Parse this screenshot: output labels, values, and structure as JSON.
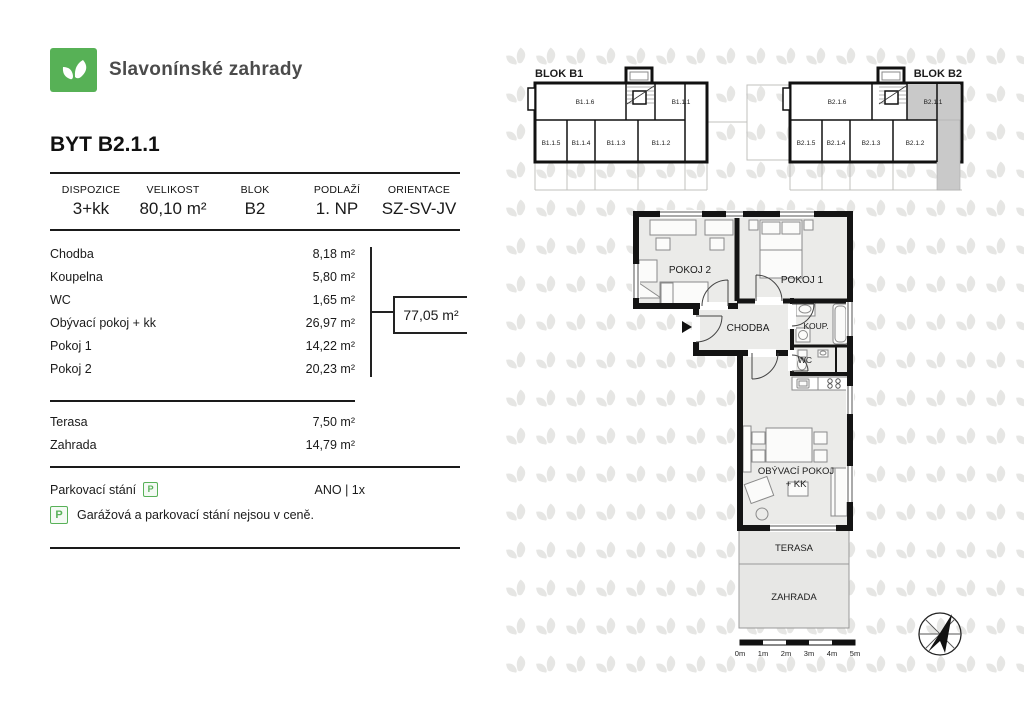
{
  "brand": {
    "name": "Slavonínské zahrady",
    "logo": "leaf-icon"
  },
  "page_title": "BYT B2.1.1",
  "specs": [
    {
      "label": "DISPOZICE",
      "value": "3+kk"
    },
    {
      "label": "VELIKOST",
      "value": "80,10 m²"
    },
    {
      "label": "BLOK",
      "value": "B2"
    },
    {
      "label": "PODLAŽÍ",
      "value": "1. NP"
    },
    {
      "label": "ORIENTACE",
      "value": "SZ-SV-JV"
    }
  ],
  "rooms": [
    {
      "name": "Chodba",
      "area": "8,18 m²"
    },
    {
      "name": "Koupelna",
      "area": "5,80 m²"
    },
    {
      "name": "WC",
      "area": "1,65 m²"
    },
    {
      "name": "Obývací pokoj + kk",
      "area": "26,97 m²"
    },
    {
      "name": "Pokoj 1",
      "area": "14,22 m²"
    },
    {
      "name": "Pokoj 2",
      "area": "20,23 m²"
    }
  ],
  "total_area": "77,05 m²",
  "outdoor": [
    {
      "name": "Terasa",
      "area": "7,50 m²"
    },
    {
      "name": "Zahrada",
      "area": "14,79 m²"
    }
  ],
  "parking": {
    "label": "Parkovací stání",
    "badge": "P",
    "value": "ANO | 1x"
  },
  "note": {
    "badge": "P",
    "text": "Garážová a parkovací stání nejsou v ceně."
  },
  "site_plan": {
    "block_b1": {
      "name": "BLOK B1",
      "units": {
        "top_left": "B1.1.6",
        "top_right": "B1.1.1",
        "bottom": [
          "B1.1.5",
          "B1.1.4",
          "B1.1.3",
          "B1.1.2"
        ]
      }
    },
    "block_b2": {
      "name": "BLOK B2",
      "units": {
        "top_left": "B2.1.6",
        "top_right": "B2.1.1",
        "bottom": [
          "B2.1.5",
          "B2.1.4",
          "B2.1.3",
          "B2.1.2"
        ]
      },
      "highlighted_unit": "B2.1.1"
    }
  },
  "floor_plan": {
    "rooms": {
      "pokoj2": "POKOJ 2",
      "pokoj1": "POKOJ 1",
      "chodba": "CHODBA",
      "koup": "KOUP.",
      "wc": "WC",
      "obyvaci_line1": "OBÝVACÍ POKOJ",
      "obyvaci_line2": "+ KK",
      "terasa": "TERASA",
      "zahrada": "ZAHRADA"
    },
    "scale": [
      "0m",
      "1m",
      "2m",
      "3m",
      "4m",
      "5m"
    ]
  },
  "colors": {
    "brand_green": "#57b156",
    "parking_green": "#58b158",
    "highlight_gray": "#c9c9c9",
    "wall_black": "#141414",
    "floor_fill": "#ebebe9"
  }
}
